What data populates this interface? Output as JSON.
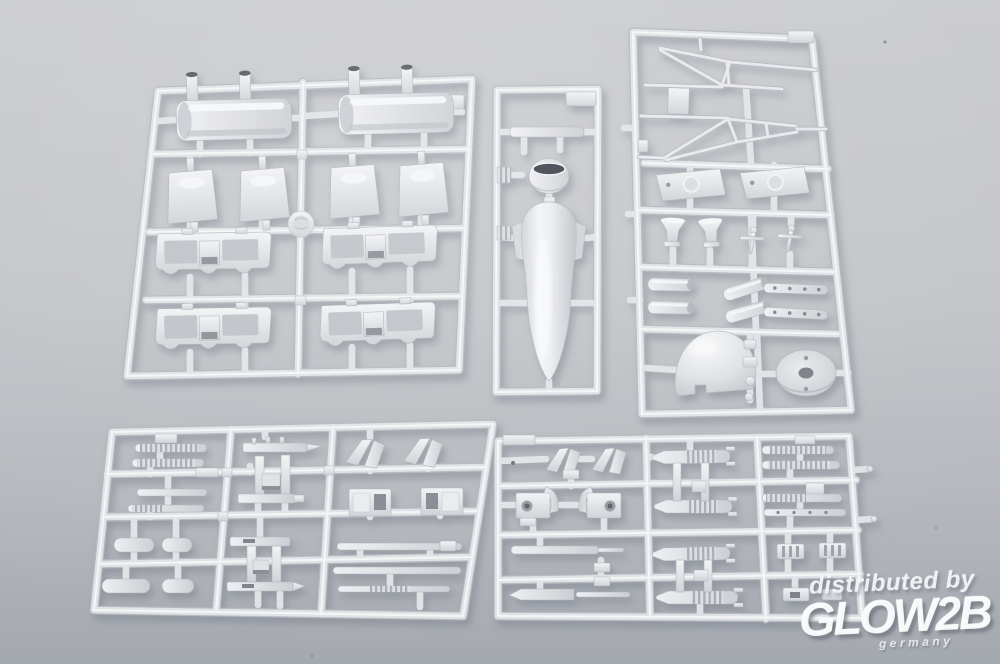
{
  "meta": {
    "type": "product-photo",
    "subject": "Injection-molded plastic scale-model kit sprues photographed on a gray background",
    "sprue_count": 5,
    "width_px": 1000,
    "height_px": 664
  },
  "palette": {
    "background_top": "#cbccd0",
    "background_bottom": "#a4a8af",
    "plastic_base": "#dfe1e4",
    "plastic_highlight": "#f3f4f6",
    "plastic_shadow": "#b3b6bc",
    "recess_dark": "#3e4148"
  },
  "watermark": {
    "line1": "distributed by",
    "logo": "GLOW2B",
    "sublabel": "germany",
    "color": "#ffffff"
  },
  "sprues": [
    {
      "id": "top-left",
      "description": "Large frame: two engine cowling pods with filler stubs, four curved hatch panels, four scalloped window-frame sections, round part-number disc"
    },
    {
      "id": "top-middle",
      "description": "Narrow frame: top tab, T-bar, cowl ring drum with dark opening, long float/fuselage half with side plates"
    },
    {
      "id": "top-right",
      "description": "Frame: thin float-strut trusses, small plate, two mount trapezoids with molded rings, two funnels, two tiny strut fittings, exhaust stacks, perforated strips, nose cone, bulkhead disc"
    },
    {
      "id": "bottom-left",
      "description": "Small-parts frame: ribbed coil strips, plain bars, capsule cylinders, twin-rail ladder assemblies with dark slots, vee plates, hollow boxes, long rods"
    },
    {
      "id": "bottom-right",
      "description": "Small-parts frame: vee plates, ring-hole brackets with curved shields, four ribbed torpedo/bomb bodies, long rods, ribbed strips, dotted strip, ribbed plates, notched brackets"
    }
  ]
}
